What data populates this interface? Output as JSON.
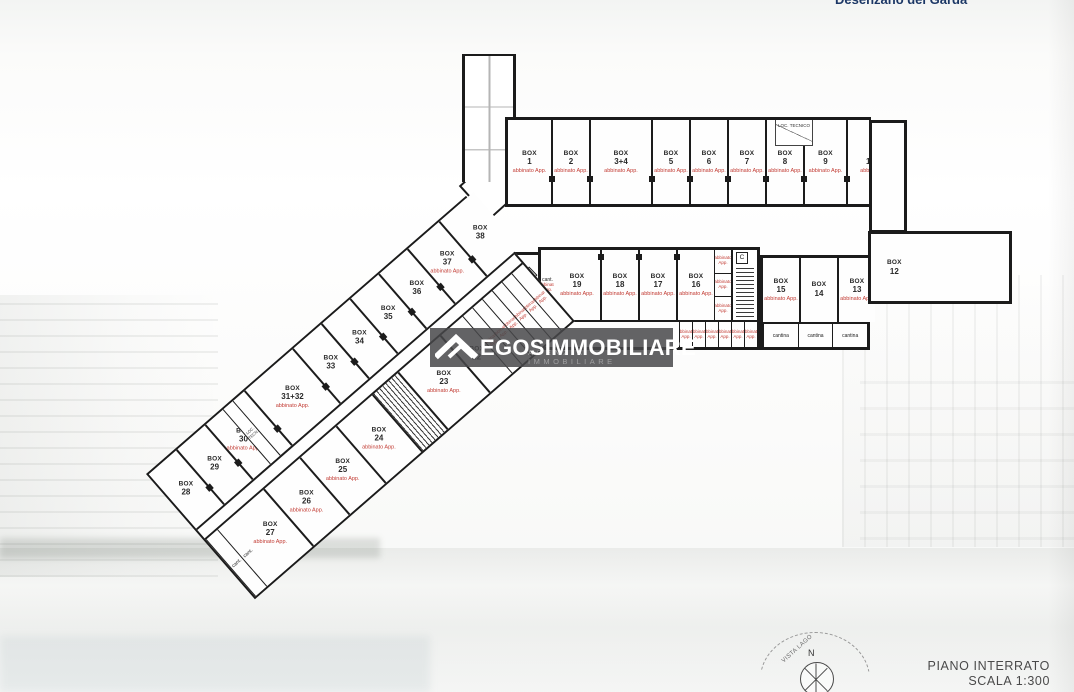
{
  "header": {
    "location": "Desenzano del Garda"
  },
  "watermark": {
    "brand": "EGOSIMMOBILIARE",
    "subtitle": "AGENZIA IMMOBILIARE"
  },
  "titleblock": {
    "floor": "PIANO INTERRATO",
    "scale": "SCALA 1:300"
  },
  "compass": {
    "north": "N",
    "view": "VISTA LAGO"
  },
  "plan": {
    "room_prefix": "BOX",
    "loc_tecnico_top": "LOC. TECNICO",
    "loc_tecnico_diag": "LOC. TECN.",
    "stair_b": "B",
    "stair_c": "C",
    "top_row": [
      {
        "num": "1",
        "note": "abbinato App."
      },
      {
        "num": "2",
        "note": "abbinato App."
      },
      {
        "num": "3+4",
        "note": "abbinato App."
      },
      {
        "num": "5",
        "note": "abbinato App."
      },
      {
        "num": "6",
        "note": "abbinato App."
      },
      {
        "num": "7",
        "note": "abbinato App."
      },
      {
        "num": "8",
        "note": "abbinato App."
      },
      {
        "num": "9",
        "note": "abbinato App."
      },
      {
        "num": "10+11",
        "note": "abbinato App."
      }
    ],
    "mid_left_cant": {
      "label": "cant.",
      "note": "abbinato App."
    },
    "mid_row_left": [
      {
        "num": "19",
        "note": "abbinato App."
      },
      {
        "num": "18",
        "note": "abbinato App."
      },
      {
        "num": "17",
        "note": "abbinato App."
      },
      {
        "num": "16",
        "note": "abbinato App."
      }
    ],
    "mid_small_cells": [
      {
        "label": "cant.",
        "note": "abbinato App."
      },
      {
        "label": "cant.",
        "note": "abbinato App."
      },
      {
        "label": "cant.",
        "note": "abbinato App."
      }
    ],
    "corridor_cells": [
      {
        "label": "cant.",
        "note": "abbinato App."
      },
      {
        "label": "cant.",
        "note": "abbinato App."
      },
      {
        "label": "cant.",
        "note": "abbinato App."
      },
      {
        "label": "cant.",
        "note": "abbinato App."
      },
      {
        "label": "cant.",
        "note": "abbinato App."
      },
      {
        "label": "cant.",
        "note": "abbinato App."
      }
    ],
    "mid_row_right": [
      {
        "num": "15",
        "note": "abbinato App."
      },
      {
        "num": "14",
        "note": ""
      },
      {
        "num": "13",
        "note": "abbinato App."
      }
    ],
    "cantina_cells_right": [
      {
        "label": "cantina"
      },
      {
        "label": "cantina"
      },
      {
        "label": "cantina"
      }
    ],
    "box_12": {
      "num": "12"
    },
    "diag_outer": [
      {
        "num": "28",
        "note": ""
      },
      {
        "num": "29",
        "note": ""
      },
      {
        "num": "30",
        "note": "abbinato App."
      },
      {
        "num": "31+32",
        "note": "abbinato App."
      },
      {
        "num": "33",
        "note": ""
      },
      {
        "num": "34",
        "note": ""
      },
      {
        "num": "35",
        "note": ""
      },
      {
        "num": "36",
        "note": ""
      },
      {
        "num": "37",
        "note": "abbinato App."
      },
      {
        "num": "38",
        "note": ""
      }
    ],
    "diag_inner_tip": [
      {
        "label": "cant."
      },
      {
        "label": "cant."
      }
    ],
    "diag_inner": [
      {
        "num": "27",
        "note": "abbinato App."
      },
      {
        "num": "26",
        "note": "abbinato App."
      },
      {
        "num": "25",
        "note": "abbinato App."
      },
      {
        "num": "24",
        "note": "abbinato App."
      }
    ],
    "box_23": {
      "num": "23",
      "note": "abbinato App."
    },
    "box_22": {
      "num": "22",
      "note": ""
    },
    "diag_cells": [
      {
        "label": "cant.",
        "note": "abbinato App."
      },
      {
        "label": "cant.",
        "note": "abbinato App."
      },
      {
        "label": "cant.",
        "note": "abbinato App."
      },
      {
        "label": "cant.",
        "note": "abbinato App."
      },
      {
        "label": "cant.",
        "note": "abbinato App."
      },
      {
        "label": "cant.",
        "note": "abbinato App."
      }
    ]
  }
}
